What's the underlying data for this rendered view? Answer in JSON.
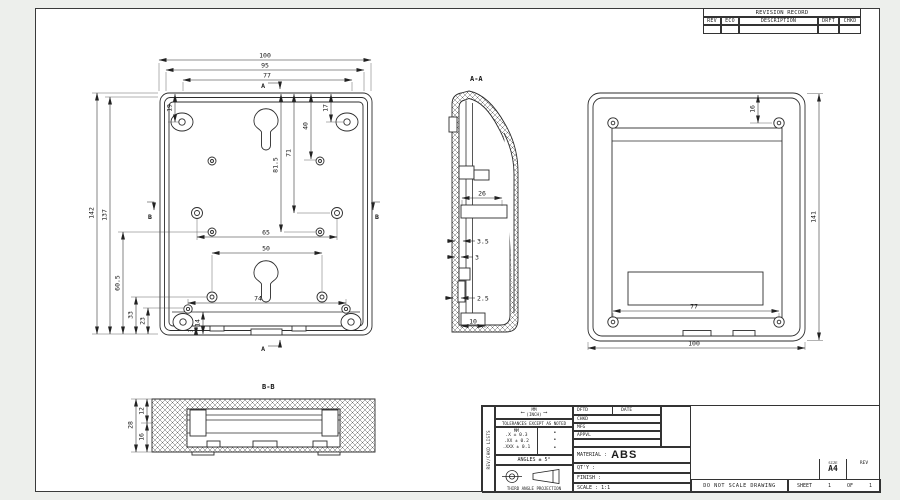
{
  "revision_table": {
    "title": "REVISION RECORD",
    "columns": [
      "REV",
      "ECO",
      "DESCRIPTION",
      "DRFT",
      "CHKD"
    ]
  },
  "drawing": {
    "main": {
      "marker_a": "A",
      "marker_b": "B",
      "d100": "100",
      "d95": "95",
      "d77": "77",
      "d19": "19",
      "d17": "17",
      "d40": "40",
      "d71": "71",
      "d815": "81.5",
      "d142": "142",
      "d137": "137",
      "d605": "60.5",
      "d33": "33",
      "d23": "23",
      "d65": "65",
      "d50": "50",
      "d74": "74",
      "d14": "14",
      "d3": "3"
    },
    "aa": {
      "label": "A-A",
      "d26": "26",
      "d35": "3.5",
      "d3": "3",
      "d25": "2.5",
      "d10": "10"
    },
    "front": {
      "d16": "16",
      "d141": "141",
      "d77": "77",
      "d100": "100"
    },
    "bb": {
      "label": "B-B",
      "d12": "12",
      "d28": "28",
      "d16": "16"
    }
  },
  "title_block": {
    "side_label": "REV/CHKD LISTS",
    "units_primary": "MM",
    "units_secondary": "(INCH)",
    "arrow_left": "⟵",
    "arrow_right": "⟶",
    "tolerances_header": "TOLERANCES EXCEPT AS NOTED",
    "tol_unit_header": "MM",
    "tol_rows": [
      ".X ± 0.3",
      ".XX ± 0.2",
      ".XXX ± 0.1"
    ],
    "tol_dots": [
      "•",
      "•",
      "•"
    ],
    "angles": "ANGLES ± 5°",
    "projection_caption": "THIRD ANGLE PROJECTION",
    "rows": {
      "dftd": "DFTD",
      "date": "DATE",
      "chkd": "CHKD",
      "mfg": "MFG",
      "appvl": "APPVL"
    },
    "material_label": "MATERIAL :",
    "material_value": "ABS",
    "qty_label": "QT'Y :",
    "finish_label": "FINISH :",
    "scale_label": "SCALE : 1:1",
    "do_not_scale": "DO NOT SCALE DRAWING",
    "sheet_label": "SHEET",
    "sheet_number": "1",
    "of_label": "OF",
    "of_number": "1",
    "size_label": "SIZE",
    "size_value": "A4",
    "rev_label": "REV"
  }
}
